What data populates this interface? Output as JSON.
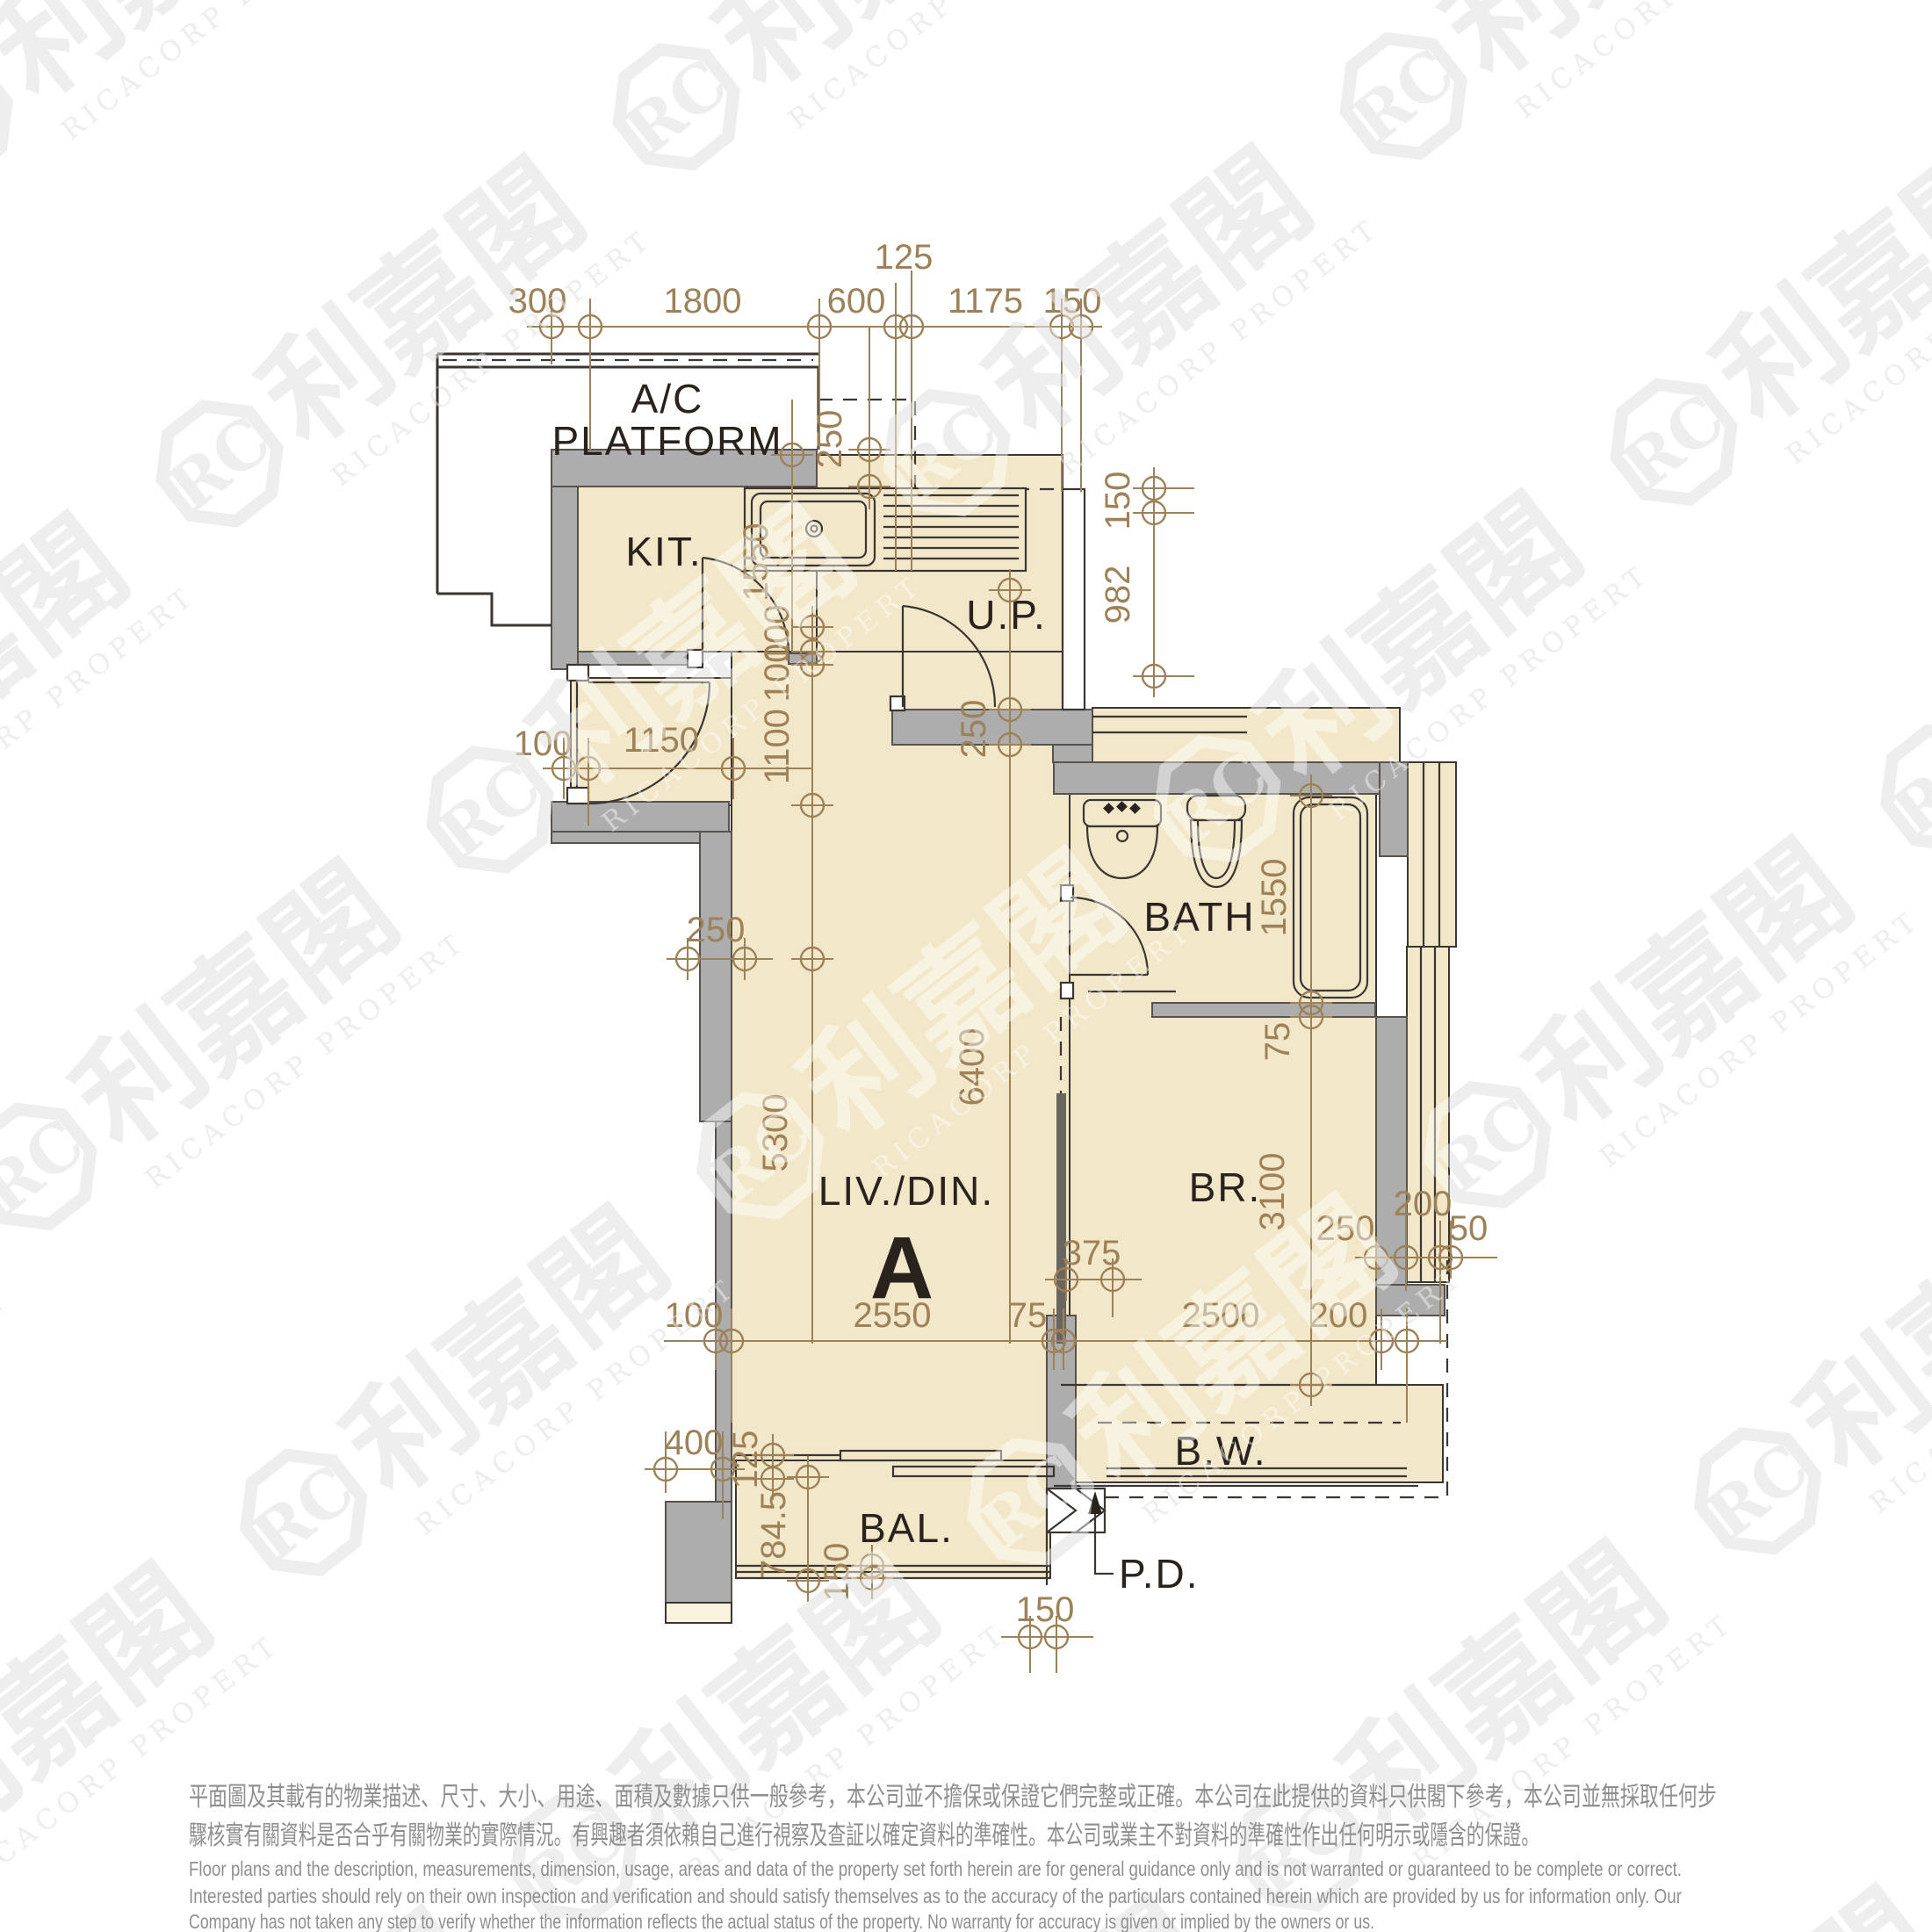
{
  "rooms": {
    "ac_line1": "A/C",
    "ac_line2": "PLATFORM",
    "kitchen": "KIT.",
    "utility": "U.P.",
    "bath": "BATH",
    "bedroom": "BR.",
    "living": "LIV./DIN.",
    "unit": "A",
    "balcony": "BAL.",
    "baywindow": "B.W.",
    "pipeduct": "P.D."
  },
  "dims": {
    "top300": "300",
    "top1800": "1800",
    "top600": "600",
    "top125": "125",
    "top1175": "1175",
    "top150": "150",
    "ac250": "250",
    "right150": "150",
    "right982": "982",
    "kit1550": "1550",
    "c100a": "100",
    "c100b": "100",
    "c1100": "1100",
    "c5300": "5300",
    "c6400": "6400",
    "e100": "100",
    "e1150": "1150",
    "w250": "250",
    "up250": "250",
    "b1550": "1550",
    "b75": "75",
    "br3100": "3100",
    "br375": "375",
    "r250": "250",
    "r200": "200",
    "r50": "50",
    "f100": "100",
    "f2550": "2550",
    "f75": "75",
    "f2500": "2500",
    "f200": "200",
    "bal400": "400",
    "bal125": "125",
    "bal7845": "784.5",
    "bal150": "150",
    "pd150": "150"
  },
  "watermark": {
    "logo": "RC",
    "cn": "利嘉閣",
    "en": "RICACORP PROPERTIES"
  },
  "disclaimer": {
    "zh1": "平面圖及其載有的物業描述、尺寸、大小、用途、面積及數據只供一般參考，本公司並不擔保或保證它們完整或正確。本公司在此提供的資料只供閣下參考，本公司並無採取任何步",
    "zh2": "驟核實有關資料是否合乎有關物業的實際情況。有興趣者須依賴自己進行視察及查証以確定資料的準確性。本公司或業主不對資料的準確性作出任何明示或隱含的保證。",
    "en1": "Floor plans and the description, measurements, dimension, usage, areas and data of the property set forth herein are for general guidance only and is not warranted or guaranteed to be complete or correct.",
    "en2": "Interested parties should rely on their own inspection and verification and should satisfy themselves as to the accuracy of the particulars contained herein which are provided by us for information only.  Our",
    "en3": "Company has not taken any step to verify whether the information reflects the actual status of the property.  No warranty for accuracy is given or implied by the owners or us."
  },
  "colors": {
    "cream": "#f3e7c9",
    "creamlight": "#faf3e0",
    "wall": "#adadad",
    "wallstroke": "#57524c",
    "ink": "#2a231d",
    "line": "#3b3632",
    "dim": "#9c8159",
    "wm": "#e0e0e0",
    "disc": "#8f8f8f"
  }
}
